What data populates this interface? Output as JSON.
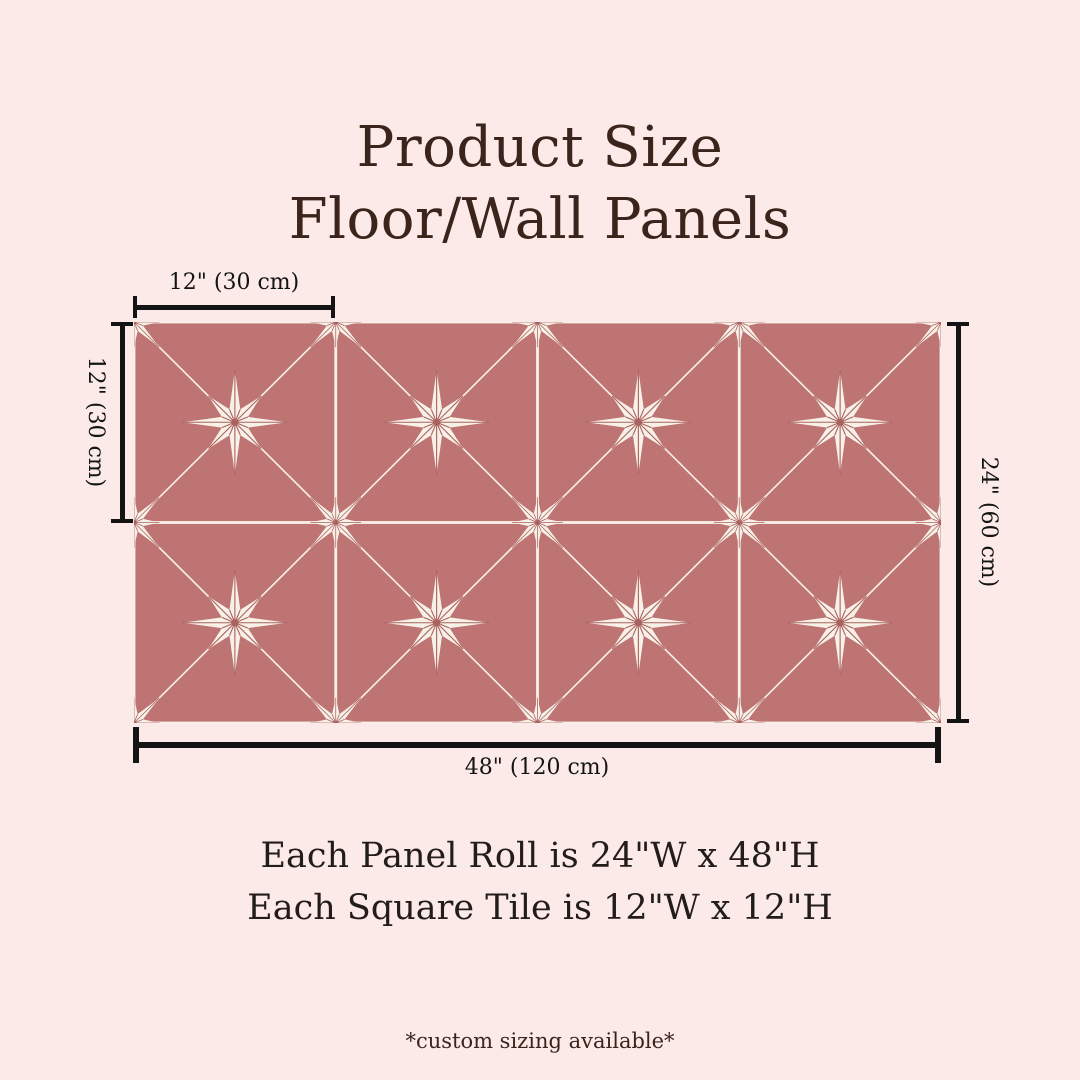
{
  "page": {
    "background": "#fceae9",
    "title_color": "#3a241c",
    "text_color": "#221c1a",
    "dimension_color": "#141414"
  },
  "title": {
    "line1": "Product Size",
    "line2": "Floor/Wall Panels"
  },
  "measurements": {
    "tile_width": "12\" (30 cm)",
    "tile_height": "12\" (30 cm)",
    "panel_height": "24\" (60 cm)",
    "panel_width": "48\" (120 cm)"
  },
  "specs": {
    "panel_roll": "Each Panel Roll is 24\"W x 48\"H",
    "square_tile": "Each Square Tile is 12\"W x 12\"H"
  },
  "footnote": "*custom sizing available*",
  "panel": {
    "rows": 2,
    "columns": 4,
    "tile_unit": 100,
    "colors": {
      "tile": "#bd7473",
      "tile_light": "#c68181",
      "star": "#f8f1e8",
      "grout": "#f8f1e8",
      "vein": "#aa625f"
    }
  }
}
